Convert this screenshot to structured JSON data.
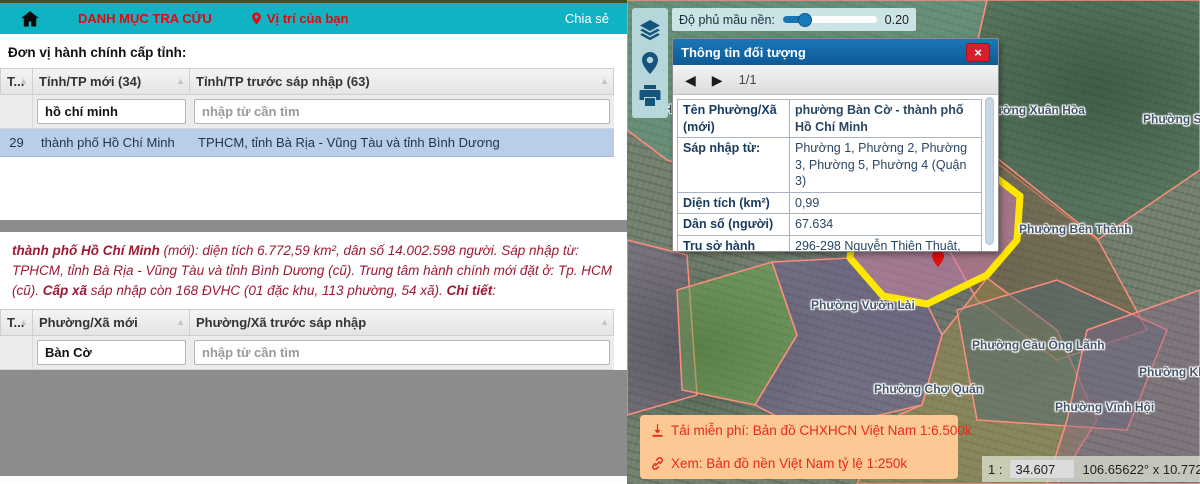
{
  "navbar": {
    "menu": "DANH MỤC TRA CỨU",
    "location": "Vị trí của bạn",
    "share": "Chia sẻ"
  },
  "section_title": "Đơn vị hành chính cấp tỉnh:",
  "province_table": {
    "col_order": "T...",
    "col_new": "Tỉnh/TP mới (34)",
    "col_old": "Tỉnh/TP trước sáp nhập (63)",
    "filter_new": "hồ chí minh",
    "filter_old_placeholder": "nhập từ cần tìm",
    "rows": [
      {
        "id": "29",
        "new": "thành phố Hồ Chí Minh",
        "old": "TPHCM, tỉnh Bà Rịa - Vũng Tàu và tỉnh Bình Dương"
      }
    ]
  },
  "summary": {
    "name_bold": "thành phố Hồ Chí Minh",
    "text1": " (mới): diện tích 6.772,59 km², dân số 14.002.598 người. Sáp nhập từ: TPHCM, tỉnh Bà Rịa - Vũng Tàu và tỉnh Bình Dương (cũ). Trung tâm hành chính mới đặt ở: Tp. HCM (cũ). ",
    "bold2": "Cấp xã",
    "text2": " sáp nhập còn 168 ĐVHC (01 đặc khu, 113 phường, 54 xã). ",
    "bold3": "Chi tiết",
    "colon": ":"
  },
  "ward_table": {
    "col_order": "T...",
    "col_new": "Phường/Xã mới",
    "col_old": "Phường/Xã trước sáp nhập",
    "filter_new": "Bàn Cờ",
    "filter_old_placeholder": "nhập từ cần tìm"
  },
  "map": {
    "opacity_label": "Độ phủ mầu nền:",
    "opacity_value": "0.20",
    "popup": {
      "title": "Thông tin đối tượng",
      "pager": "1/1",
      "rows": [
        {
          "label": "Tên Phường/Xã (mới)",
          "value": "phường Bàn Cờ - thành phố Hồ Chí Minh"
        },
        {
          "label": "Sáp nhập từ:",
          "value": "Phường 1, Phường 2, Phường 3, Phường 5, Phường 4 (Quận 3)"
        },
        {
          "label": "Diện tích (km²)",
          "value": "0,99"
        },
        {
          "label": "Dân số (người)",
          "value": "67.634"
        },
        {
          "label": "Trụ sở hành chính (mới)",
          "value": "296-298 Nguyễn Thiện Thuật, phường 3, quận 3 cũ"
        }
      ]
    },
    "download_line": "Tải miễn phí: Bản đồ CHXHCN Việt Nam 1:6.500k",
    "view_line": "Xem: Bản đồ nền Việt Nam tỷ lệ 1:250k",
    "scale_prefix": "1 :",
    "scale_value": "34.607",
    "coords": "106.65622° x 10.77207",
    "labels": [
      "Phường Xuân Hòa",
      "Phường Sài Gòn",
      "Phường Bến Thành",
      "Phường Vườn Lài",
      "Phường Chợ Quán",
      "Phường Cầu Ông Lãnh",
      "Phường Vĩnh Hội",
      "Phường Khánh Hội",
      "Tran Hò"
    ]
  },
  "colors": {
    "navbar": "#10b3c4",
    "nav_red": "#e40808",
    "selected_row": "#b9cee9",
    "summary_red": "#9c1a33",
    "popup_header": "#0d5a96",
    "selection_yellow": "#ffe800",
    "download_box": "#fcc893"
  }
}
